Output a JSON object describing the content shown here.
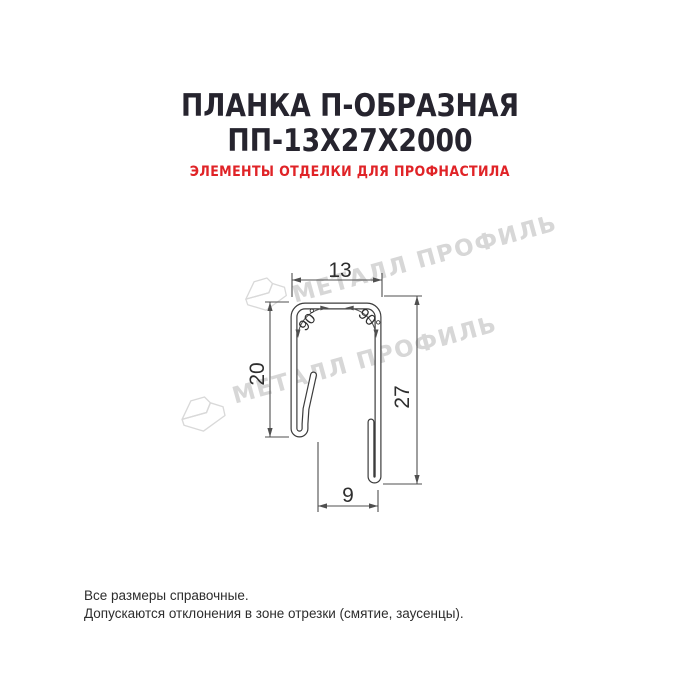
{
  "header": {
    "title_line1": "ПЛАНКА П-ОБРАЗНАЯ",
    "title_line2": "ПП-13Х27Х2000",
    "subtitle": "ЭЛЕМЕНТЫ ОТДЕЛКИ ДЛЯ ПРОФНАСТИЛА"
  },
  "watermark": {
    "brand_text": "МЕТАЛЛ ПРОФИЛЬ"
  },
  "drawing": {
    "dimensions": {
      "top_width": "13",
      "left_height": "20",
      "right_height": "27",
      "bottom_width": "9",
      "angle_left": "90°",
      "angle_right": "90°"
    }
  },
  "footer": {
    "line1": "Все размеры справочные.",
    "line2": "Допускаются отклонения в зоне отрезки (смятие, заусенцы)."
  },
  "colors": {
    "background": "#ffffff",
    "title": "#26242e",
    "subtitle": "#e02327",
    "drawing_line": "#3c3c3c",
    "dimension_line": "#4f4f4f",
    "watermark": "#d7d7d7"
  }
}
